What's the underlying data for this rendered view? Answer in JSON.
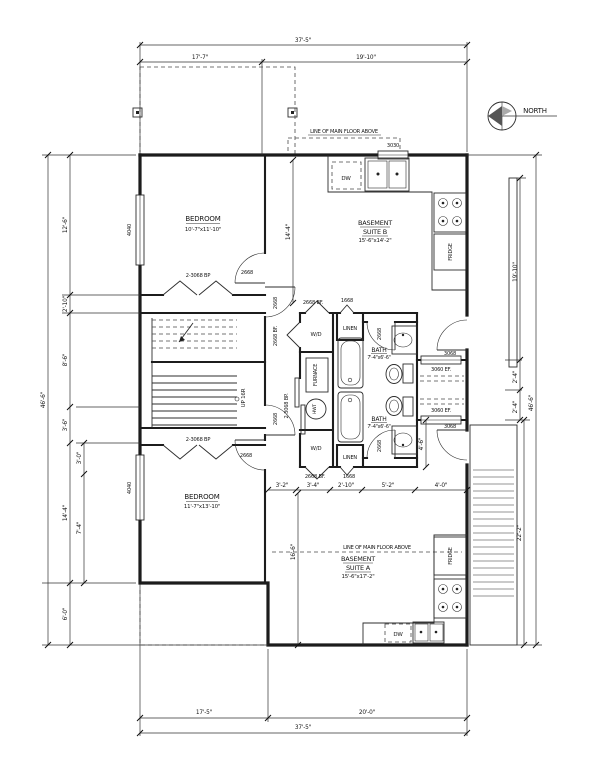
{
  "compass": {
    "label": "NORTH"
  },
  "notes": {
    "floor_above_top": "LINE OF MAIN FLOOR ABOVE",
    "floor_above_bottom": "LINE OF MAIN FLOOR ABOVE"
  },
  "rooms": {
    "bedroom_top": {
      "name": "BEDROOM",
      "size": "10'-7\"x11'-10\""
    },
    "bedroom_bottom": {
      "name": "BEDROOM",
      "size": "11'-7\"x13'-10\""
    },
    "suite_b": {
      "name1": "BASEMENT",
      "name2": "SUITE B",
      "size": "15'-6\"x14'-2\""
    },
    "suite_a": {
      "name1": "BASEMENT",
      "name2": "SUITE A",
      "size": "15'-6\"x17'-2\""
    },
    "bath_top": {
      "name": "BATH",
      "size": "7'-4\"x6'-6\""
    },
    "bath_bottom": {
      "name": "BATH",
      "size": "7'-4\"x6'-6\""
    },
    "linen_top": "LINEN",
    "linen_bottom": "LINEN",
    "laundry_top": "W/D",
    "laundry_bottom": "W/D",
    "furnace": "FURNACE",
    "water_tank": "HWT",
    "stairs": "UP 16R"
  },
  "appliances": {
    "dw_top": "DW",
    "dw_bottom": "DW",
    "fridge_top": "FRIDGE",
    "fridge_bottom": "FRIDGE"
  },
  "openings": {
    "window_3030": "3030",
    "window_4040_top": "4040",
    "window_4040_bottom": "4040",
    "window_3060_top": "3060 EF.",
    "window_3060_bottom": "3060 EF.",
    "door_bedroom_top": "2668",
    "door_bedroom_bottom": "2668",
    "door_suite_b": "2668",
    "door_suite_a": "2668",
    "door_bath_top": "2668",
    "door_bath_bottom": "2668",
    "door_entry_b": "3068",
    "door_entry_a": "3068",
    "bifold_closet_top": "2-3068 BP",
    "bifold_closet_bottom": "2-3068 BP",
    "bifold_wd_top": "2668 BF.",
    "bifold_wd_bottom": "2668 BF.",
    "door_linen_top": "1668",
    "door_linen_bottom": "1668",
    "bifold_hall": "2668 BF.",
    "bypass_hall": "2-3068 BP."
  },
  "dimensions": {
    "top_overall": "37'-5\"",
    "top_left": "17'-7\"",
    "top_right": "19'-10\"",
    "bottom_left": "17'-5\"",
    "bottom_right": "20'-0\"",
    "bottom_overall": "37'-5\"",
    "left_overall": "46'-6\"",
    "left_a": "12'-6\"",
    "left_b": "2'-10\"",
    "left_c": "8'-6\"",
    "left_d": "3'-6\"",
    "left_e": "3'-0\"",
    "left_f": "14'-4\"",
    "left_g": "7'-4\"",
    "left_h": "6'-0\"",
    "right_overall": "46'-6\"",
    "right_a": "19'-10\"",
    "right_b": "2'-4\"",
    "right_c": "2'-4\"",
    "right_stair": "22'-2\"",
    "mid_hall_v": "14'-4\"",
    "suite_a_v": "16'-6\"",
    "bath_v": "4'-6\"",
    "hall_a": "3'-2\"",
    "hall_b": "3'-4\"",
    "hall_c": "2'-10\"",
    "hall_d": "5'-2\"",
    "hall_e": "4'-0\""
  }
}
